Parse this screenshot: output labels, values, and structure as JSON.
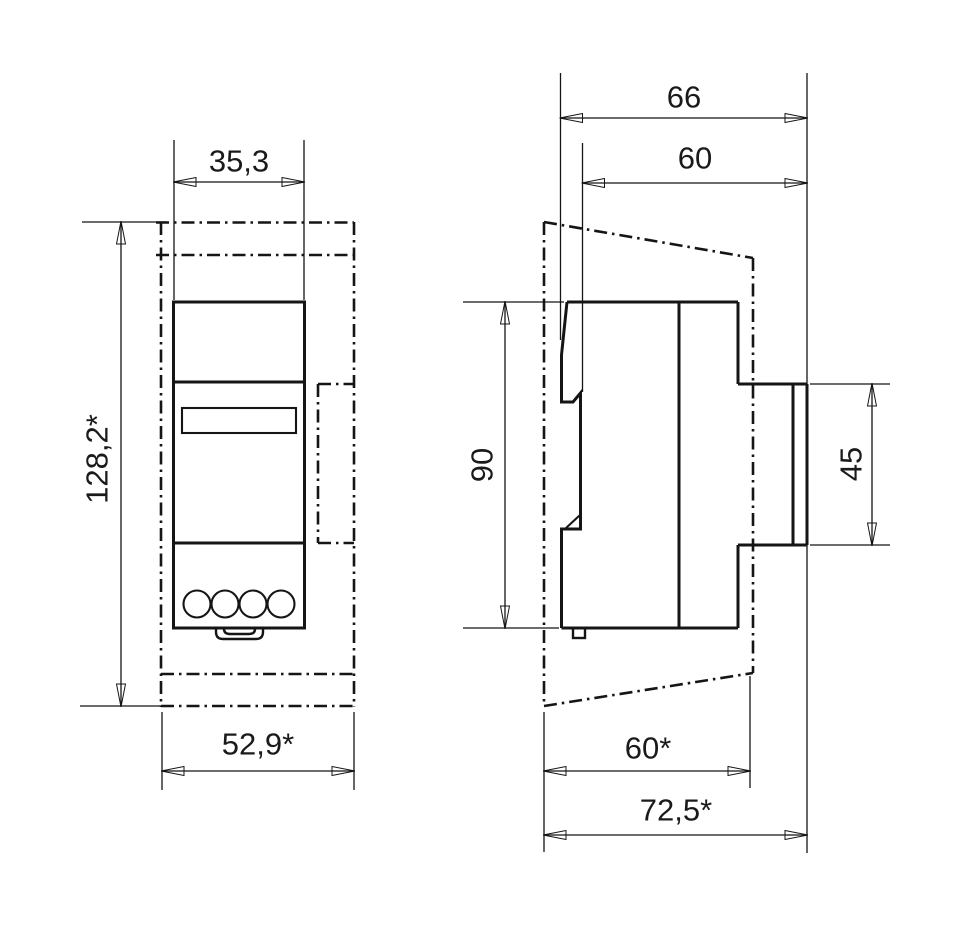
{
  "drawing": {
    "line_color": "#151515",
    "background": "#ffffff",
    "front_view": {
      "dims": {
        "width_top": "35,3",
        "height_overall": "128,2*",
        "width_bottom": "52,9*"
      }
    },
    "side_view": {
      "dims": {
        "depth_overall_top": "66",
        "depth_body_top": "60",
        "height_body": "90",
        "height_front_panel": "45",
        "depth_bottom": "60*",
        "depth_overall_bottom": "72,5*"
      }
    }
  }
}
